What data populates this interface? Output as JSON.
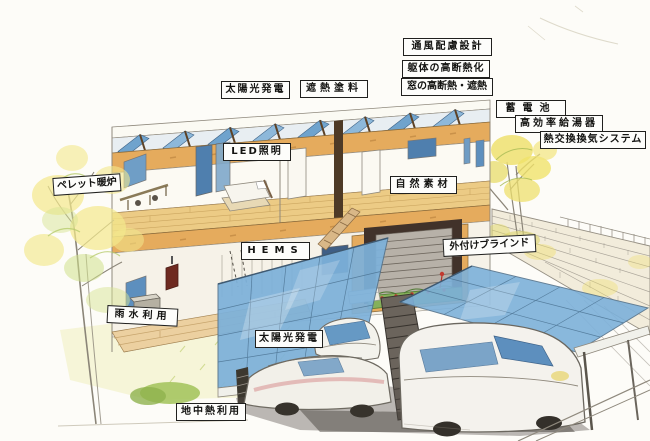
{
  "scene": {
    "type": "hand-drawn colored-pencil illustration",
    "subject": "two-story eco house cutaway with rooftop solar panels, solar carport, cars, trees and stone wall"
  },
  "labels": [
    {
      "id": "ventilation-design",
      "text": "通風配慮設計"
    },
    {
      "id": "frame-high-insulation",
      "text": "躯体の高断熱化"
    },
    {
      "id": "window-insulation-shading",
      "text": "窓の高断熱・遮熱"
    },
    {
      "id": "solar-power-roof",
      "text": "太陽光発電"
    },
    {
      "id": "heat-shield-paint",
      "text": "遮熱塗料"
    },
    {
      "id": "storage-battery",
      "text": "蓄電池"
    },
    {
      "id": "high-efficiency-water-heater",
      "text": "高効率給湯器"
    },
    {
      "id": "heat-exchange-ventilation-system",
      "text": "熱交換換気システム"
    },
    {
      "id": "led-lighting",
      "text": "LED照明"
    },
    {
      "id": "pellet-stove",
      "text": "ペレット暖炉"
    },
    {
      "id": "natural-materials",
      "text": "自然素材"
    },
    {
      "id": "hems",
      "text": "HEMS"
    },
    {
      "id": "external-blinds",
      "text": "外付けブラインド"
    },
    {
      "id": "rainwater-use",
      "text": "雨水利用"
    },
    {
      "id": "solar-power-carport",
      "text": "太陽光発電"
    },
    {
      "id": "geothermal-use",
      "text": "地中熱利用"
    }
  ],
  "colors": {
    "paper": "#fdfcf8",
    "wood_tan": "#e5ab5d",
    "solar_panel_blue": "#7db1da",
    "window_blue": "#5d8fbe",
    "foliage_yellow": "#f3e88c",
    "foliage_green": "#cfe08a",
    "graphite_shadow": "#57514a",
    "label_bg": "#fdfdfb",
    "label_border": "#20201e"
  }
}
